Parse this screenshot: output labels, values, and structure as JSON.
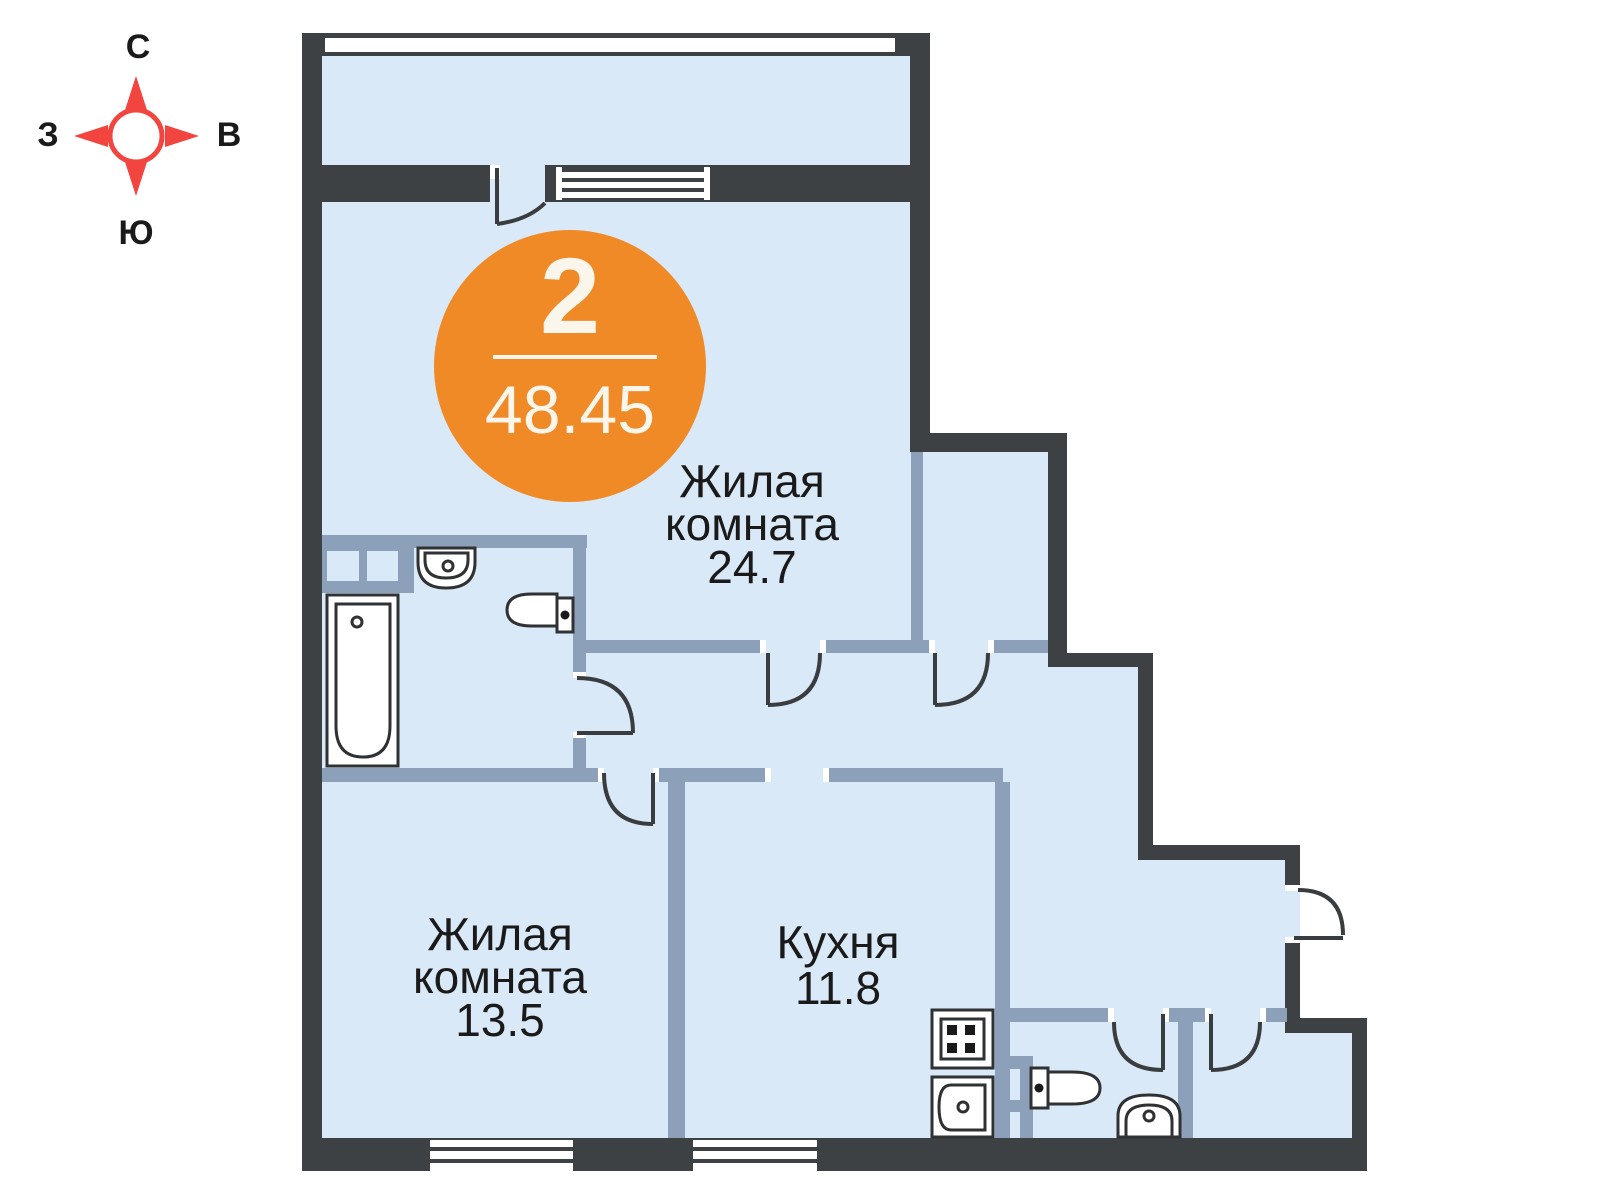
{
  "compass": {
    "north": "С",
    "south": "Ю",
    "west": "З",
    "east": "В"
  },
  "badge": {
    "room_count": "2",
    "total_area": "48.45"
  },
  "rooms": {
    "living1": {
      "line1": "Жилая",
      "line2": "комната",
      "area": "24.7"
    },
    "living2": {
      "line1": "Жилая",
      "line2": "комната",
      "area": "13.5"
    },
    "kitchen": {
      "name": "Кухня",
      "area": "11.8"
    }
  },
  "colors": {
    "floor": "#DAE9F7",
    "outer_wall": "#3E4144",
    "inner_wall": "#8CA0B9",
    "badge_orange": "#F08A26",
    "compass_red": "#F2453F",
    "text": "#1A1A1A"
  }
}
